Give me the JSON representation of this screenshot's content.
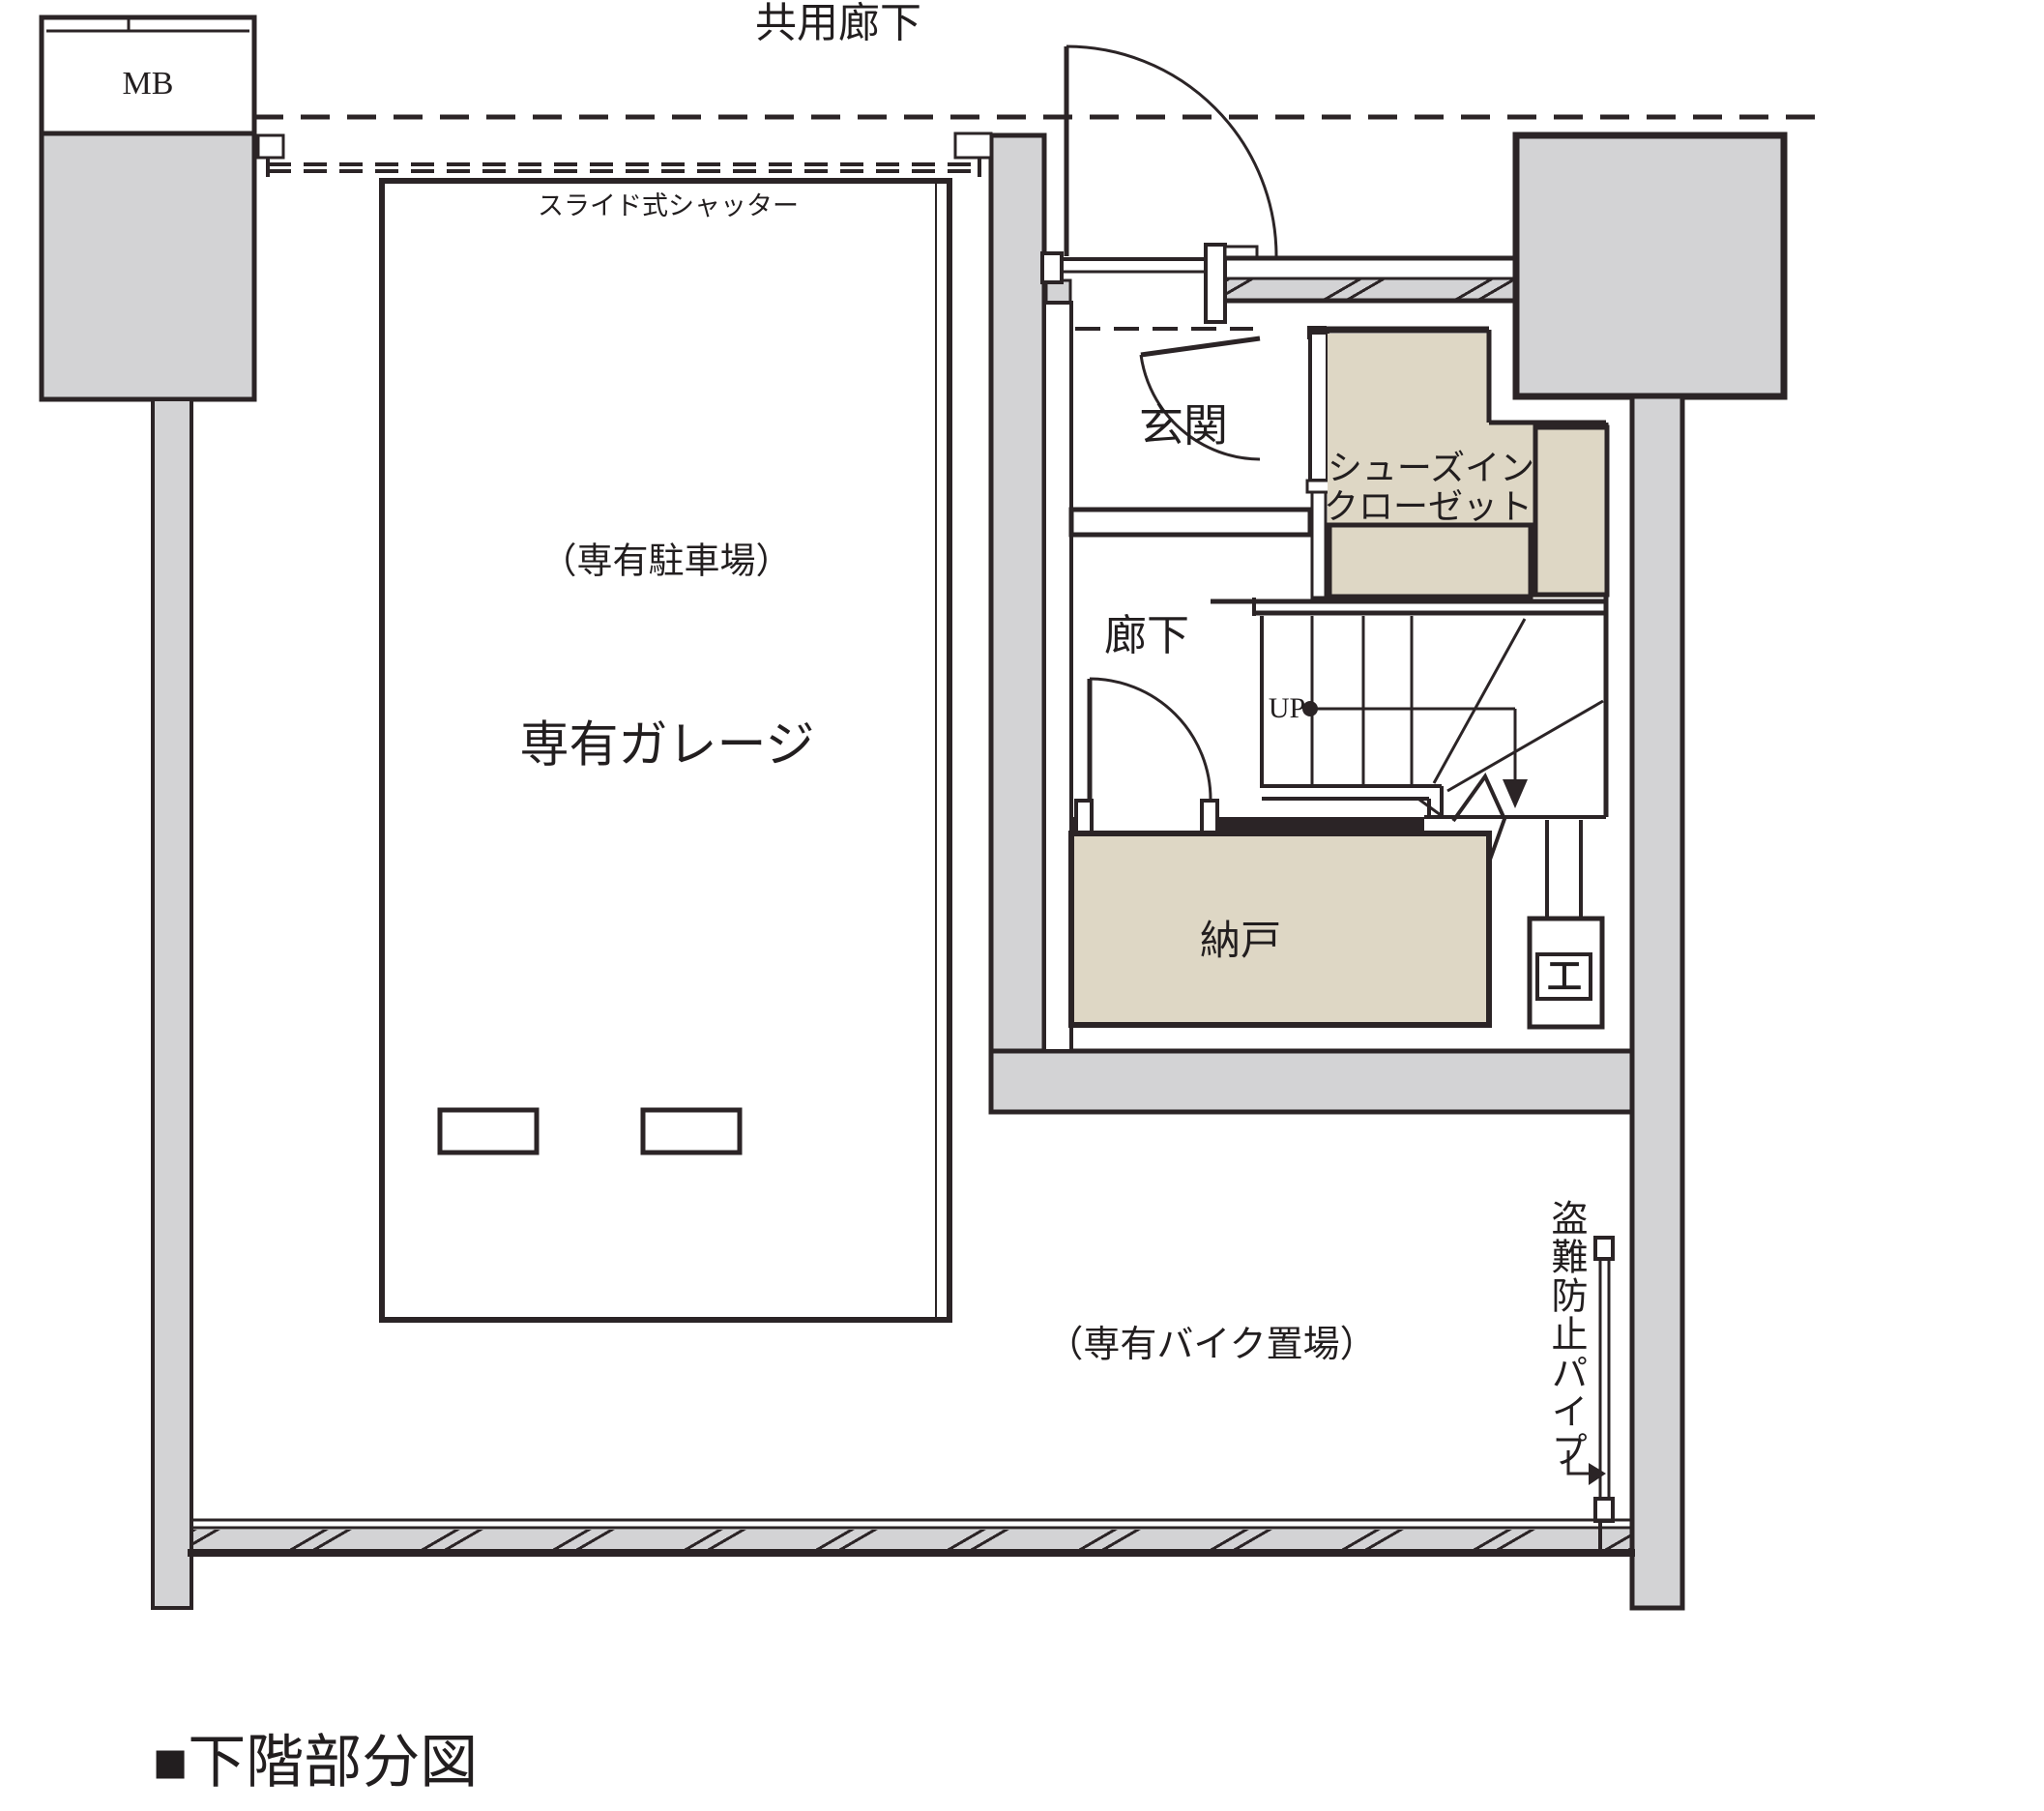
{
  "colors": {
    "wall_gray": "#d3d3d5",
    "room_beige": "#ded7c5",
    "line": "#2b2426",
    "text": "#221e1f"
  },
  "labels": {
    "shared_corridor": "共用廊下",
    "meter_box": "MB",
    "sliding_shutter": "スライド式シャッター",
    "private_parking_note": "（専有駐車場）",
    "private_garage": "専有ガレージ",
    "entrance": "玄関",
    "shoes_closet_line1": "シューズイン",
    "shoes_closet_line2": "クローゼット",
    "hallway": "廊下",
    "up": "UP",
    "storage_room": "納戸",
    "private_bike_note": "（専有バイク置場）",
    "anti_theft_pipe": "盗難防止パイプ",
    "caption_marker": "■",
    "caption": "下階部分図"
  },
  "icons": {
    "steel_column": "工"
  }
}
